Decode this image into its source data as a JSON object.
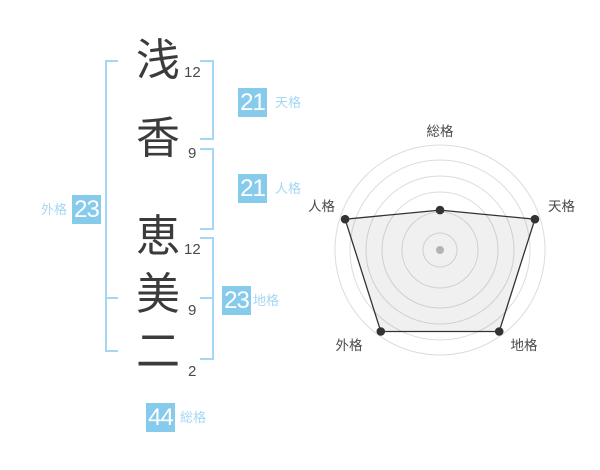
{
  "name_display": {
    "chars": [
      {
        "char": "浅",
        "strokes": "12",
        "part": "surname"
      },
      {
        "char": "香",
        "strokes": "9",
        "part": "surname"
      },
      {
        "char": "恵",
        "strokes": "12",
        "part": "given"
      },
      {
        "char": "美",
        "strokes": "9",
        "part": "given"
      },
      {
        "char": "二",
        "strokes": "2",
        "part": "given"
      }
    ]
  },
  "categories": {
    "tenkaku": {
      "label": "天格",
      "value": "21"
    },
    "jinkaku": {
      "label": "人格",
      "value": "21"
    },
    "chikaku": {
      "label": "地格",
      "value": "23"
    },
    "gaikaku": {
      "label": "外格",
      "value": "23"
    },
    "soukaku": {
      "label": "総格",
      "value": "44"
    }
  },
  "colors": {
    "badge_blue": "#87CBEC",
    "light_blue": "#A4D7F3",
    "kanji_ink": "#3B3B3B",
    "stroke_count_gray": "#4A4A4A",
    "radar_line": "#333333",
    "radar_grid": "#DCDCDC",
    "radar_fill": "rgba(0,0,0,0.057)",
    "radar_label_gray": "#4A4A4A",
    "radar_center_dot": "#BFBFBF"
  },
  "chart_data": {
    "type": "radar",
    "axes": [
      {
        "label": "総格",
        "value_percent": 38
      },
      {
        "label": "天格",
        "value_percent": 95
      },
      {
        "label": "地格",
        "value_percent": 96
      },
      {
        "label": "外格",
        "value_percent": 96
      },
      {
        "label": "人格",
        "value_percent": 95
      }
    ],
    "max_percent": 100,
    "outer_radius_px": 105,
    "ring_radii_px": [
      17,
      38,
      58,
      74,
      90,
      105
    ],
    "grid": "concentric-circles",
    "legend": false,
    "title": ""
  }
}
